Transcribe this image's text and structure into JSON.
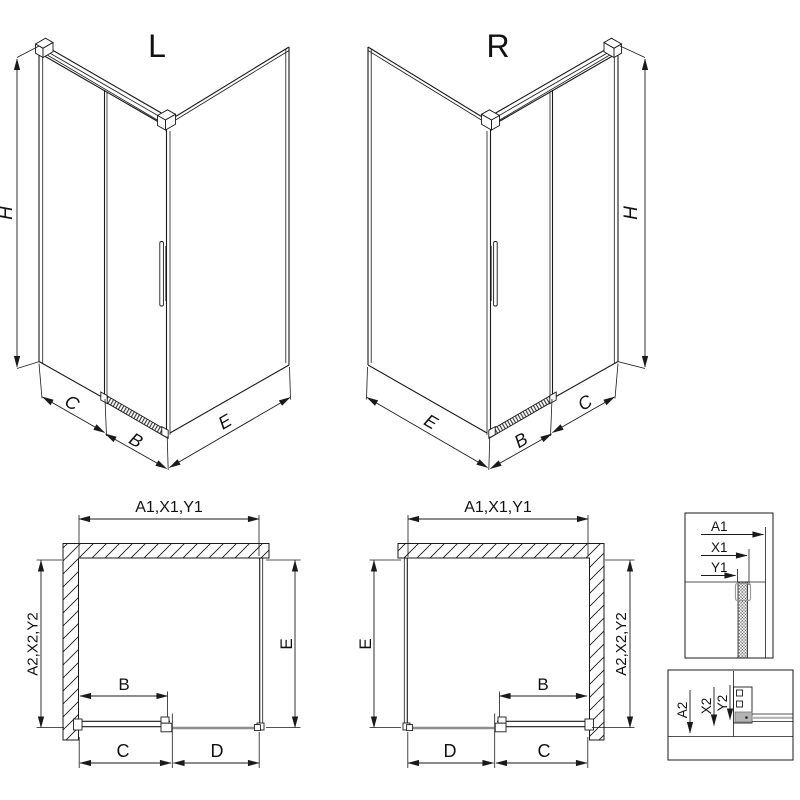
{
  "drawing": {
    "iso_left": {
      "title": "L",
      "dims": {
        "h": "H",
        "c": "C",
        "b": "B",
        "e": "E"
      }
    },
    "iso_right": {
      "title": "R",
      "dims": {
        "h": "H",
        "c": "C",
        "b": "B",
        "e": "E"
      }
    },
    "plan_left": {
      "width_label": "A1,X1,Y1",
      "depth_label": "A2,X2,Y2",
      "dims": {
        "e": "E",
        "b": "B",
        "c": "C",
        "d": "D"
      }
    },
    "plan_right": {
      "width_label": "A1,X1,Y1",
      "depth_label": "A2,X2,Y2",
      "dims": {
        "e": "E",
        "b": "B",
        "c": "C",
        "d": "D"
      }
    },
    "detail_width": {
      "rows": [
        "A1",
        "X1",
        "Y1"
      ]
    },
    "detail_depth": {
      "rows": [
        "A2",
        "X2",
        "Y2"
      ]
    },
    "colors": {
      "line": "#1a1a1a",
      "fixed_panel_gray": "#8f8f8f",
      "shoe_gray": "#b3b3b3"
    }
  }
}
